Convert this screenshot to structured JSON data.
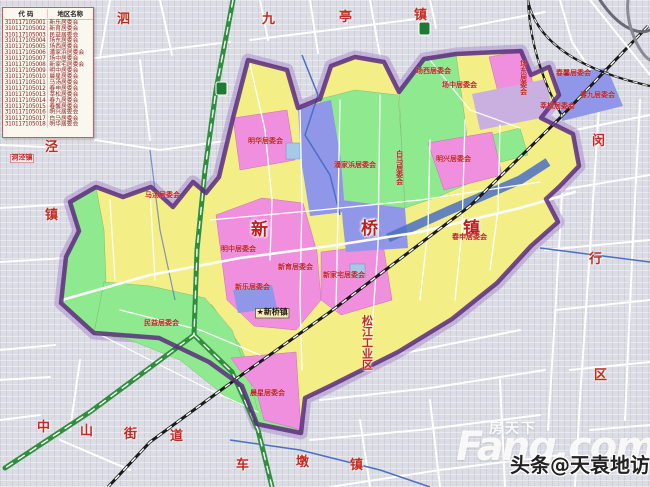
{
  "legend": {
    "headers": {
      "code": "代 码",
      "name": "地区名称"
    },
    "rows": [
      {
        "code": "310117105001",
        "name": "新乐居委会"
      },
      {
        "code": "310117105002",
        "name": "新育居委会"
      },
      {
        "code": "310117105003",
        "name": "民益居委会"
      },
      {
        "code": "310117105004",
        "name": "场东居委会"
      },
      {
        "code": "310117105005",
        "name": "场西居委会"
      },
      {
        "code": "310117105006",
        "name": "潘家浜居委会"
      },
      {
        "code": "310117105007",
        "name": "场中居委会"
      },
      {
        "code": "310117105008",
        "name": "新家宅居委会"
      },
      {
        "code": "310117105009",
        "name": "明中居委会"
      },
      {
        "code": "310117105010",
        "name": "晨星居委会"
      },
      {
        "code": "310117105011",
        "name": "马汤居委会"
      },
      {
        "code": "310117105012",
        "name": "春申居委会"
      },
      {
        "code": "310117105013",
        "name": "莘松居委会"
      },
      {
        "code": "310117105014",
        "name": "春九居委会"
      },
      {
        "code": "310117105015",
        "name": "春馨居委会"
      },
      {
        "code": "310117105016",
        "name": "明兴居委会"
      },
      {
        "code": "310117105017",
        "name": "白马居委会"
      },
      {
        "code": "310117105018",
        "name": "明华居委会"
      }
    ]
  },
  "map": {
    "labels": [
      {
        "id": "town-name-char-xin",
        "t": "新",
        "x": 251,
        "y": 222,
        "fs": 17,
        "cls": "town"
      },
      {
        "id": "town-name-char-qiao",
        "t": "桥",
        "x": 361,
        "y": 221,
        "fs": 17,
        "cls": "town"
      },
      {
        "id": "town-name-char-zhen",
        "t": "镇",
        "x": 463,
        "y": 221,
        "fs": 17,
        "cls": "town"
      },
      {
        "id": "area-jiuting-1",
        "t": "九",
        "x": 262,
        "y": 13,
        "fs": 13,
        "cls": "area"
      },
      {
        "id": "area-jiuting-2",
        "t": "亭",
        "x": 339,
        "y": 11,
        "fs": 13,
        "cls": "area"
      },
      {
        "id": "area-jiuting-3",
        "t": "镇",
        "x": 414,
        "y": 9,
        "fs": 13,
        "cls": "area"
      },
      {
        "id": "area-sijing-1",
        "t": "泗",
        "x": 117,
        "y": 13,
        "fs": 13,
        "cls": "area"
      },
      {
        "id": "area-sijing-2",
        "t": "泾",
        "x": 45,
        "y": 141,
        "fs": 13,
        "cls": "area"
      },
      {
        "id": "area-sijing-3",
        "t": "镇",
        "x": 45,
        "y": 209,
        "fs": 13,
        "cls": "area"
      },
      {
        "id": "area-dongjing",
        "t": "洞泾镇",
        "x": 10,
        "y": 154,
        "fs": 7,
        "cls": "box"
      },
      {
        "id": "area-minhang-1",
        "t": "闵",
        "x": 592,
        "y": 135,
        "fs": 13,
        "cls": "area"
      },
      {
        "id": "area-minhang-2",
        "t": "行",
        "x": 589,
        "y": 253,
        "fs": 13,
        "cls": "area"
      },
      {
        "id": "area-minhang-3",
        "t": "区",
        "x": 594,
        "y": 369,
        "fs": 13,
        "cls": "area"
      },
      {
        "id": "area-songjiang-industrial",
        "t": "松江工业区",
        "x": 361,
        "y": 315,
        "fs": 11,
        "cls": "area",
        "v": 1
      },
      {
        "id": "area-chedun-1",
        "t": "车",
        "x": 236,
        "y": 459,
        "fs": 13,
        "cls": "area"
      },
      {
        "id": "area-chedun-2",
        "t": "墩",
        "x": 296,
        "y": 456,
        "fs": 13,
        "cls": "area"
      },
      {
        "id": "area-chedun-3",
        "t": "镇",
        "x": 350,
        "y": 459,
        "fs": 13,
        "cls": "area"
      },
      {
        "id": "area-zhongshan-1",
        "t": "中",
        "x": 37,
        "y": 421,
        "fs": 13,
        "cls": "area"
      },
      {
        "id": "area-zhongshan-2",
        "t": "山",
        "x": 80,
        "y": 425,
        "fs": 13,
        "cls": "area"
      },
      {
        "id": "area-zhongshan-3",
        "t": "街",
        "x": 124,
        "y": 428,
        "fs": 13,
        "cls": "area"
      },
      {
        "id": "area-zhongshan-4",
        "t": "道",
        "x": 170,
        "y": 430,
        "fs": 13,
        "cls": "area"
      },
      {
        "id": "seat-xinqiao-town",
        "t": "★新桥镇",
        "x": 255,
        "y": 308,
        "fs": 8,
        "cls": "seat"
      },
      {
        "id": "committee-matang",
        "t": "马汤居委会",
        "x": 145,
        "y": 192,
        "fs": 7,
        "cls": "com"
      },
      {
        "id": "committee-minyi",
        "t": "民益居委会",
        "x": 144,
        "y": 320,
        "fs": 7,
        "cls": "com"
      },
      {
        "id": "committee-panjiabang",
        "t": "潘家浜居委会",
        "x": 334,
        "y": 162,
        "fs": 7,
        "cls": "com"
      },
      {
        "id": "committee-baima",
        "t": "白马居委会",
        "x": 394,
        "y": 150,
        "fs": 7,
        "cls": "com",
        "v": 1
      },
      {
        "id": "committee-minghua",
        "t": "明华居委会",
        "x": 248,
        "y": 138,
        "fs": 7,
        "cls": "com"
      },
      {
        "id": "committee-mingzhong",
        "t": "明中居委会",
        "x": 221,
        "y": 246,
        "fs": 7,
        "cls": "com"
      },
      {
        "id": "committee-xinle",
        "t": "新乐居委会",
        "x": 235,
        "y": 284,
        "fs": 7,
        "cls": "com"
      },
      {
        "id": "committee-xinyu",
        "t": "新育居委会",
        "x": 278,
        "y": 264,
        "fs": 7,
        "cls": "com"
      },
      {
        "id": "committee-xinjiazhai",
        "t": "新家宅居委会",
        "x": 323,
        "y": 272,
        "fs": 7,
        "cls": "com"
      },
      {
        "id": "committee-chenxing",
        "t": "晨星居委会",
        "x": 250,
        "y": 390,
        "fs": 7,
        "cls": "com"
      },
      {
        "id": "committee-mingxing",
        "t": "明兴居委会",
        "x": 436,
        "y": 156,
        "fs": 7,
        "cls": "com"
      },
      {
        "id": "committee-changxi",
        "t": "场西居委会",
        "x": 416,
        "y": 68,
        "fs": 7,
        "cls": "com"
      },
      {
        "id": "committee-changzhong",
        "t": "场中居委会",
        "x": 442,
        "y": 82,
        "fs": 7,
        "cls": "com"
      },
      {
        "id": "committee-changdong",
        "t": "场东居委会",
        "x": 518,
        "y": 60,
        "fs": 7,
        "cls": "com",
        "v": 1
      },
      {
        "id": "committee-chunxin",
        "t": "春馨居委会",
        "x": 556,
        "y": 70,
        "fs": 7,
        "cls": "com"
      },
      {
        "id": "committee-chunjiu",
        "t": "春九居委会",
        "x": 580,
        "y": 92,
        "fs": 7,
        "cls": "com"
      },
      {
        "id": "committee-xinsong",
        "t": "莘松居委会",
        "x": 540,
        "y": 103,
        "fs": 7,
        "cls": "com"
      },
      {
        "id": "committee-chunshen",
        "t": "春申居委会",
        "x": 452,
        "y": 234,
        "fs": 7,
        "cls": "com"
      }
    ]
  },
  "watermark": {
    "brand_cn": "房天下",
    "brand_en": "Fang.com",
    "byline": "头条@天袁地访"
  },
  "colors": {
    "boundary": "#5a2d7d",
    "boundary_halo": "#a887cc",
    "region_yellow": "#f3ef86",
    "region_green": "#8fe98f",
    "region_pink": "#ef8fdd",
    "region_blue": "#9097e8",
    "region_lavender": "#c9b0e0",
    "river": "#4a6fc4",
    "railway": "#1a1a1a",
    "highway": "#2f8f3f",
    "label_red": "#c21d1d"
  }
}
